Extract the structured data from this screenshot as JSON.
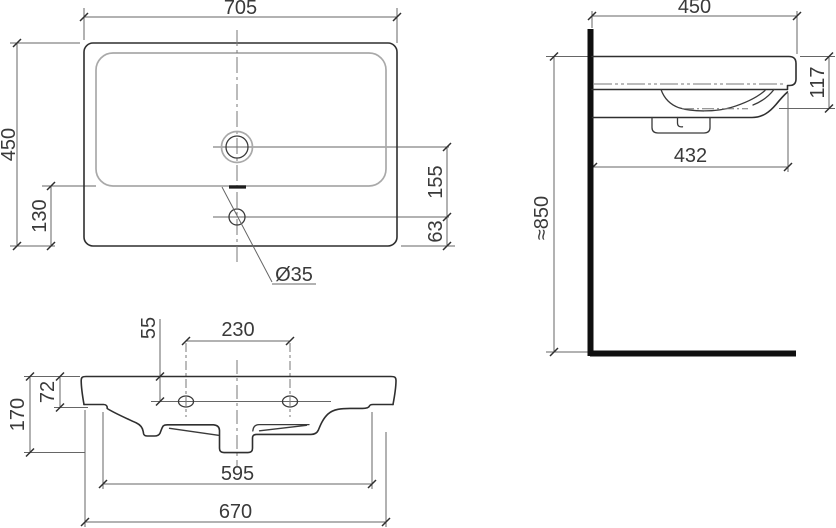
{
  "drawing": {
    "product": "Wall-hung washbasin dimension drawing",
    "unit": "mm",
    "top_view": {
      "overall_width": "705",
      "overall_depth": "450",
      "bowl_to_front": "130",
      "drain_to_tap": "155",
      "tap_to_front": "63",
      "tap_hole_diameter": "Ø35"
    },
    "front_view": {
      "tap_hole_drop": "55",
      "tap_hole_spacing": "230",
      "rim_thickness": "72",
      "overall_height": "170",
      "inner_width": "595",
      "body_width": "670"
    },
    "side_view": {
      "overall_depth": "450",
      "front_height": "117",
      "depth_below_rim": "432",
      "mounting_height": "≈850"
    }
  }
}
